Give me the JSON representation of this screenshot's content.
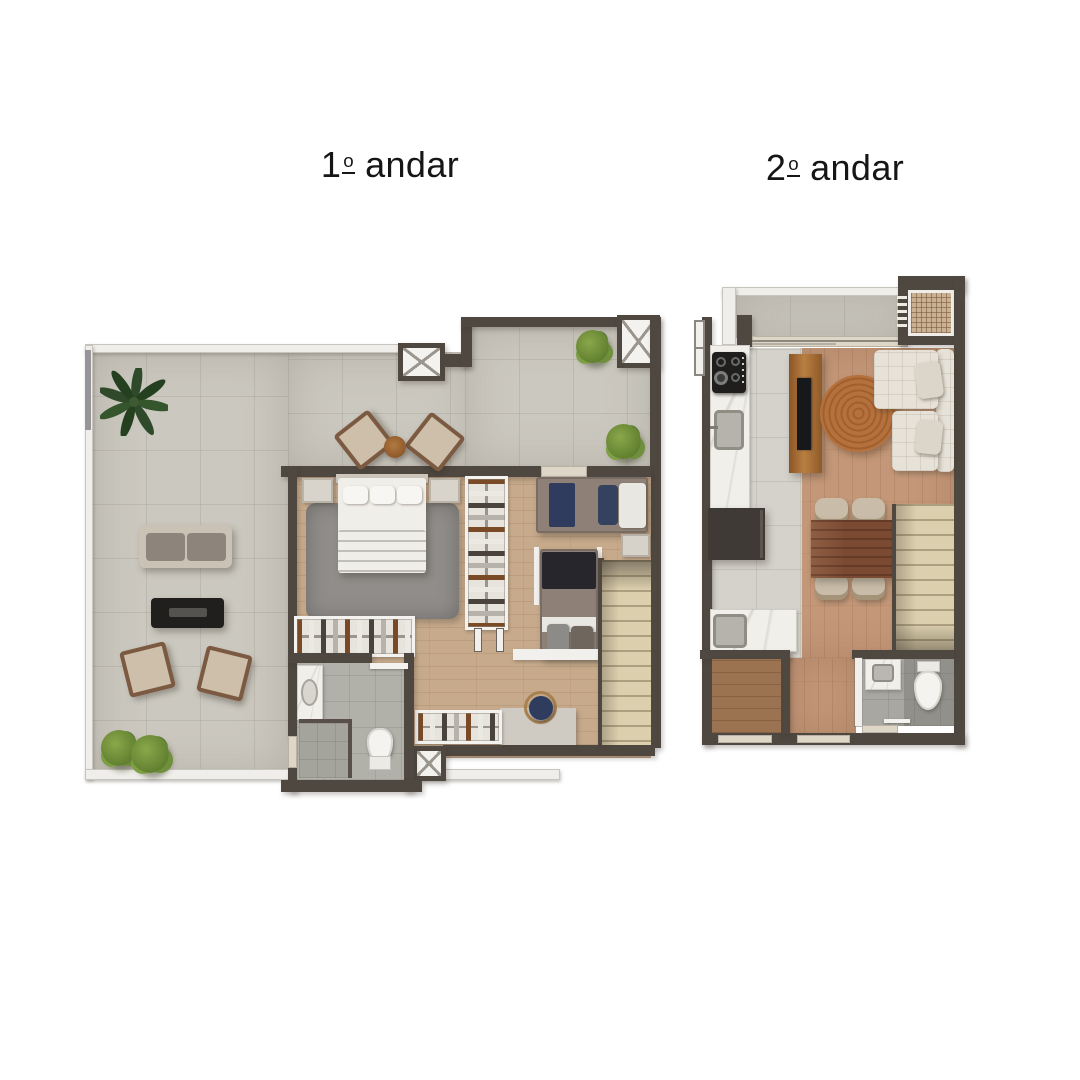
{
  "titles": {
    "floor1": {
      "number": "1",
      "ordinal": "o",
      "word": "andar"
    },
    "floor2": {
      "number": "2",
      "ordinal": "o",
      "word": "andar"
    }
  },
  "palette": {
    "wall-dark": "#4f4841",
    "wall-white": "#f0eeea",
    "sill": "#ded6c7",
    "terrace-tile": "#cbc8bf",
    "indoor-wood": "#c7aa8b",
    "hall-wood": "#c39778",
    "foyer-wood": "#9b7351",
    "kitchen-tile": "#d4d2ca",
    "bath-tile": "#b1b0a9",
    "stairs": "#dccfae",
    "marble": "#f1efe9",
    "rug-gray": "#908d8a",
    "rug-jute": "#b4713d",
    "sofa-cream": "#e7e2d8",
    "bed-white": "#f0eee9",
    "bed-taupe": "#8e8076",
    "navy": "#2f3c5e",
    "black-item": "#201f1d",
    "bush-green": "#6f8f3a",
    "palm-green": "#2e4a2b",
    "table-wood": "#7b4a32",
    "console-wood": "#a87038",
    "cabinet-dark": "#3f3a35"
  },
  "floor1": {
    "label": "1º andar",
    "furniture": [
      "palm plant",
      "outdoor sofa",
      "fire pit table",
      "lounge armchairs",
      "deck chairs",
      "side table",
      "bushes",
      "double bed",
      "nightstands",
      "area rug",
      "closet hangers",
      "single bed",
      "trundle bed",
      "desk",
      "desk chair",
      "clothes racks",
      "staircase",
      "bathroom sink",
      "shower",
      "toilet",
      "elevator shafts"
    ]
  },
  "floor2": {
    "label": "2º andar",
    "furniture": [
      "balcony",
      "ac grille",
      "cooktop",
      "kitchen sink",
      "kitchen counter",
      "tall cabinet",
      "tv console",
      "tv",
      "round jute rug",
      "l-shaped sofa",
      "dining table",
      "dining chairs",
      "staircase",
      "bathroom sink",
      "toilet",
      "entry foyer"
    ]
  }
}
